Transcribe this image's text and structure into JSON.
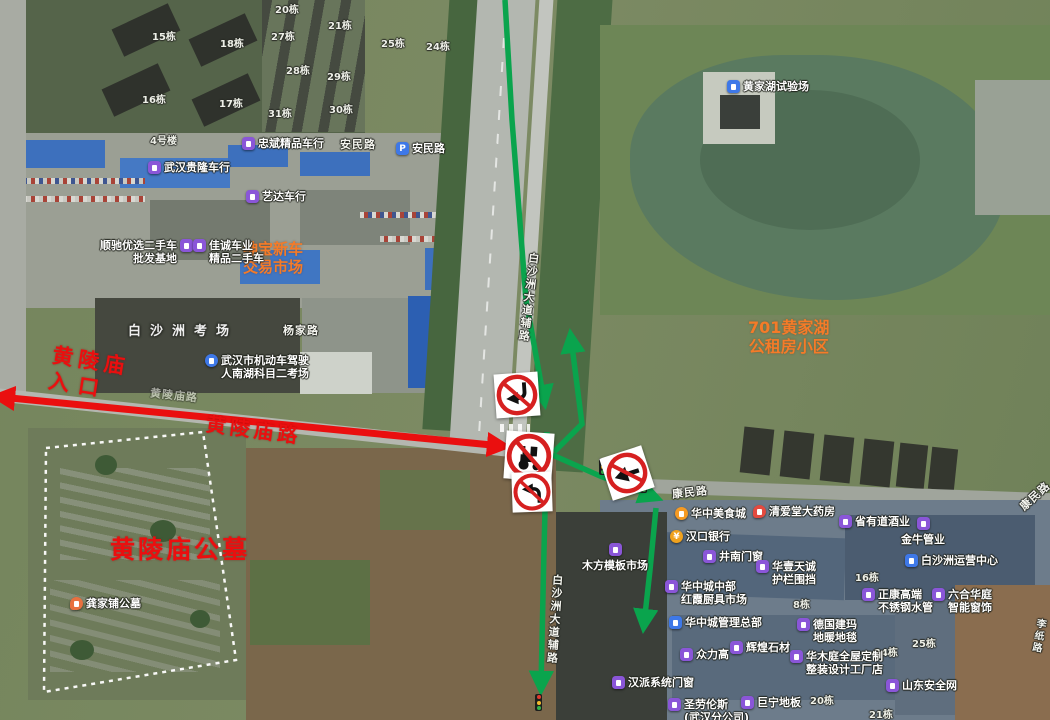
{
  "colors": {
    "annotation_red": "#ea0f0f",
    "route_green": "#0aa44d",
    "poi_purple": "#8a56d8",
    "poi_blue": "#3e78e8",
    "poi_food_orange": "#f59a23",
    "poi_pharmacy_red": "#e34a3f",
    "orange_area_label": "#f57b28",
    "dashed_boundary_white": "#ffffff"
  },
  "annotations": {
    "entrance_line1": "黄陵庙",
    "entrance_line2": "入口",
    "road": "黄陵庙路",
    "cemetery": "黄陵庙公墓"
  },
  "area_labels": {
    "driving_exam": "白沙洲考场",
    "car_market_line1": "绅宝新车",
    "car_market_line2": "交易市场",
    "apartment_line1": "701黄家湖",
    "apartment_line2": "公租房小区"
  },
  "road_labels": [
    "安民路",
    "杨家路",
    "康民路",
    "康民路",
    "白沙洲大道辅路",
    "白沙洲大道辅路",
    "李纸路",
    "黄陵庙路"
  ],
  "building_labels": [
    "15栋",
    "18栋",
    "16栋",
    "17栋",
    "20栋",
    "21栋",
    "27栋",
    "28栋",
    "29栋",
    "30栋",
    "31栋",
    "25栋",
    "24栋",
    "4号楼",
    "8栋",
    "16栋",
    "24栋",
    "25栋",
    "20栋",
    "21栋"
  ],
  "pois": [
    {
      "icon": "shop",
      "lines": [
        "忠斌精品车行"
      ]
    },
    {
      "icon": "parking",
      "lines": [
        "安民路"
      ]
    },
    {
      "icon": "shop",
      "lines": [
        "武汉贵隆车行"
      ]
    },
    {
      "icon": "shop",
      "lines": [
        "艺达车行"
      ]
    },
    {
      "icon": "shop",
      "lines": [
        "顺驰优选二手车",
        "批发基地"
      ]
    },
    {
      "icon": "shop",
      "lines": [
        "佳诚车业",
        "精品二手车"
      ]
    },
    {
      "icon": "school",
      "lines": [
        "武汉市机动车驾驶",
        "人南湖科目二考场"
      ]
    },
    {
      "icon": "company",
      "lines": [
        "黄家湖试验场"
      ]
    },
    {
      "icon": "food",
      "lines": [
        "华中美食城"
      ]
    },
    {
      "icon": "pharmacy",
      "lines": [
        "清爱堂大药房"
      ]
    },
    {
      "icon": "bank",
      "lines": [
        "汉口银行"
      ]
    },
    {
      "icon": "shop",
      "lines": [
        "井南门窗"
      ]
    },
    {
      "icon": "shop",
      "lines": [
        "华壹天诚",
        "护栏围挡"
      ]
    },
    {
      "icon": "shop",
      "lines": [
        "华中城中部",
        "红霞厨具市场"
      ]
    },
    {
      "icon": "shop",
      "lines": [
        "省有道酒业"
      ]
    },
    {
      "icon": "shop",
      "lines": [
        "金牛管业"
      ]
    },
    {
      "icon": "company",
      "lines": [
        "白沙洲运营中心"
      ]
    },
    {
      "icon": "shop",
      "lines": [
        "正康高端",
        "不锈钢水管"
      ]
    },
    {
      "icon": "shop",
      "lines": [
        "六合华庭",
        "智能窗饰"
      ]
    },
    {
      "icon": "shop",
      "lines": [
        "木方模板市场"
      ]
    },
    {
      "icon": "company",
      "lines": [
        "华中城管理总部"
      ]
    },
    {
      "icon": "shop",
      "lines": [
        "众力高"
      ]
    },
    {
      "icon": "shop",
      "lines": [
        "辉煌石材"
      ]
    },
    {
      "icon": "shop",
      "lines": [
        "德国建玛",
        "地暖地毯"
      ]
    },
    {
      "icon": "shop",
      "lines": [
        "华木庭全屋定制",
        "整装设计工厂店"
      ]
    },
    {
      "icon": "shop",
      "lines": [
        "山东安全网"
      ]
    },
    {
      "icon": "shop",
      "lines": [
        "汉派系统门窗"
      ]
    },
    {
      "icon": "shop",
      "lines": [
        "圣劳伦斯",
        "(武汉分公司)"
      ]
    },
    {
      "icon": "shop",
      "lines": [
        "巨宁地板"
      ]
    },
    {
      "icon": "cemetery",
      "lines": [
        "龚家铺公墓"
      ]
    }
  ],
  "signs": [
    {
      "name": "no-left-turn"
    },
    {
      "name": "no-agricultural-vehicles"
    },
    {
      "name": "no-left-turn"
    },
    {
      "name": "no-left-turn"
    }
  ]
}
